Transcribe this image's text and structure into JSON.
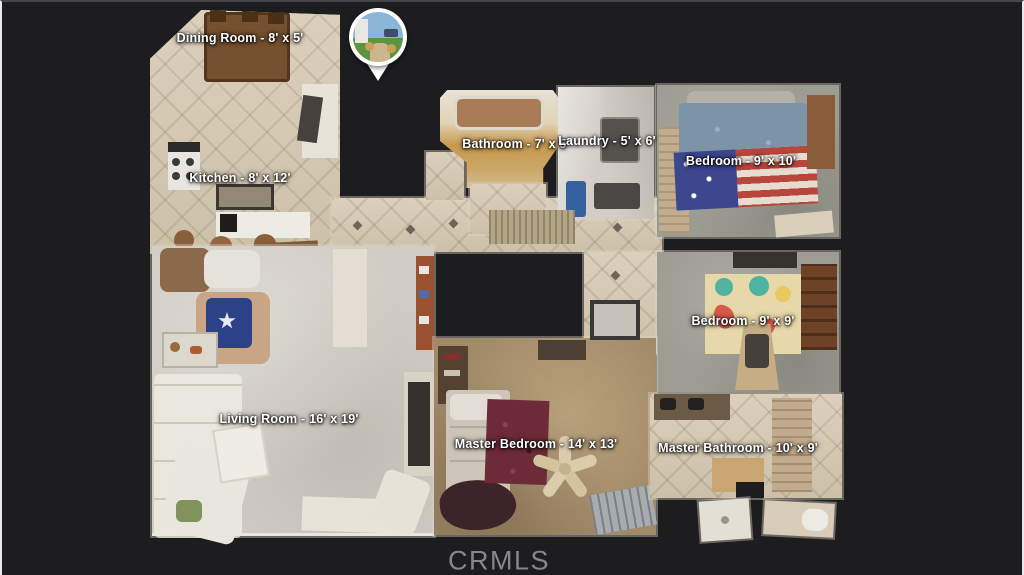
{
  "viewer": {
    "watermark": "CRMLS",
    "background_color": "#1d1d20",
    "label_text_color": "#ffffff"
  },
  "map_pin": {
    "type": "street-photo-location-marker",
    "photo_colors": {
      "sky": "#8cb6d8",
      "grass": "#5e9440",
      "path": "#ccb68e"
    }
  },
  "rooms": [
    {
      "id": "dining-room",
      "name": "Dining Room",
      "dimensions": "8' x 5'",
      "label": "Dining Room - 8' x 5'"
    },
    {
      "id": "kitchen",
      "name": "Kitchen",
      "dimensions": "8' x 12'",
      "label": "Kitchen - 8' x 12'"
    },
    {
      "id": "bathroom",
      "name": "Bathroom",
      "dimensions": "7' x 5'",
      "label": "Bathroom - 7' x 5'"
    },
    {
      "id": "laundry",
      "name": "Laundry",
      "dimensions": "5' x 6'",
      "label": "Laundry - 5' x 6'"
    },
    {
      "id": "bedroom-1",
      "name": "Bedroom",
      "dimensions": "9' x 10'",
      "label": "Bedroom - 9' x 10'"
    },
    {
      "id": "bedroom-2",
      "name": "Bedroom",
      "dimensions": "9' x 9'",
      "label": "Bedroom - 9' x 9'"
    },
    {
      "id": "living-room",
      "name": "Living Room",
      "dimensions": "16' x 19'",
      "label": "Living Room - 16' x 19'"
    },
    {
      "id": "master-bedroom",
      "name": "Master Bedroom",
      "dimensions": "14' x 13'",
      "label": "Master Bedroom - 14' x 13'"
    },
    {
      "id": "master-bathroom",
      "name": "Master Bathroom",
      "dimensions": "10' x 9'",
      "label": "Master Bathroom - 10' x 9'"
    }
  ]
}
